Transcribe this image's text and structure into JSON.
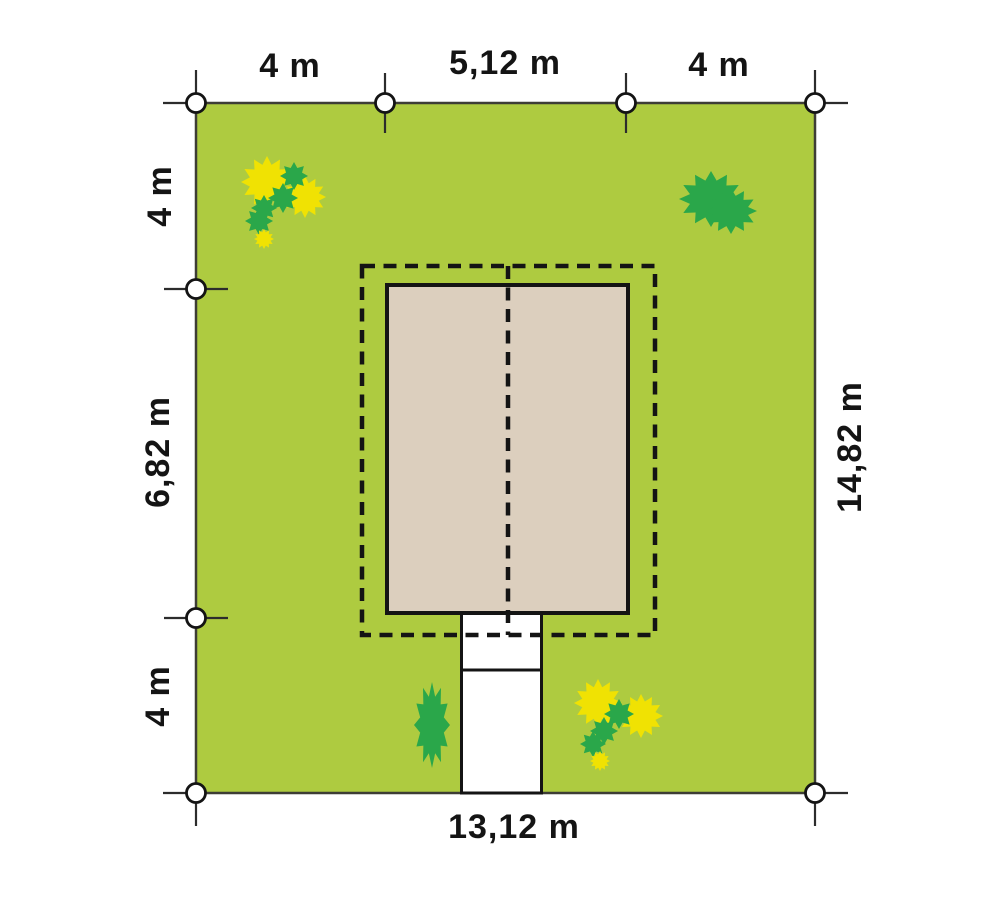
{
  "plan": {
    "dimensions": {
      "top_left": "4 m",
      "top_middle": "5,12 m",
      "top_right": "4 m",
      "left_top": "4 m",
      "left_middle": "6,82 m",
      "left_bottom": "4 m",
      "right_side": "14,82 m",
      "bottom": "13,12 m"
    },
    "colors": {
      "lawn": "#aecb40",
      "house_fill": "#dccfbe",
      "bush_green": "#2aa74a",
      "bush_yellow": "#f0e203",
      "line": "#141414",
      "plot_border": "#3d3d35",
      "paving": "#ffffff",
      "background": "#ffffff"
    }
  }
}
